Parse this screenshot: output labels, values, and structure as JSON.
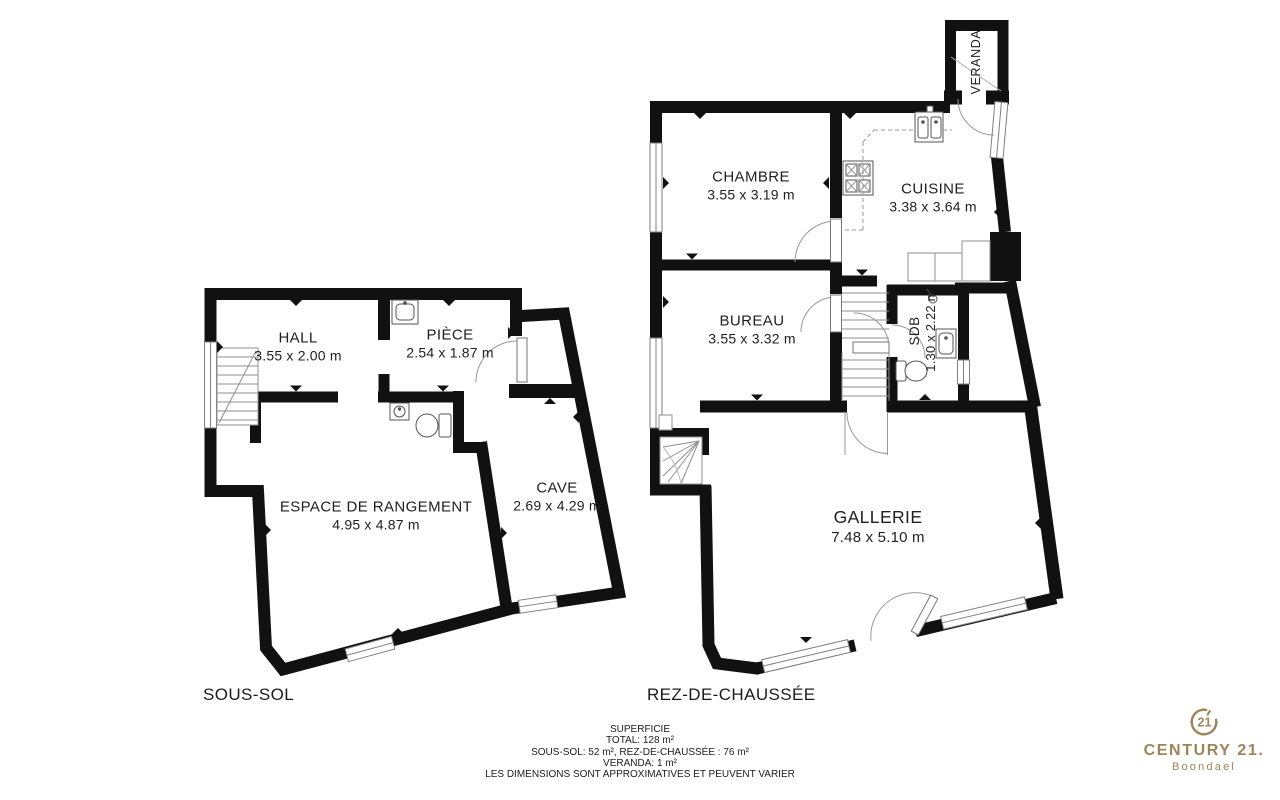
{
  "plans": {
    "sous_sol": {
      "label": "SOUS-SOL",
      "rooms": {
        "hall": {
          "name": "HALL",
          "dims": "3.55 x 2.00 m"
        },
        "piece": {
          "name": "PIÈCE",
          "dims": "2.54 x 1.87 m"
        },
        "espace_de_rangement": {
          "name": "ESPACE DE RANGEMENT",
          "dims": "4.95 x 4.87 m"
        },
        "cave": {
          "name": "CAVE",
          "dims": "2.69 x 4.29 m"
        }
      }
    },
    "rez_de_chaussee": {
      "label": "REZ-DE-CHAUSSÉE",
      "rooms": {
        "veranda": {
          "name": "VERANDA"
        },
        "chambre": {
          "name": "CHAMBRE",
          "dims": "3.55 x 3.19 m"
        },
        "cuisine": {
          "name": "CUISINE",
          "dims": "3.38 x 3.64 m"
        },
        "bureau": {
          "name": "BUREAU",
          "dims": "3.55 x 3.32 m"
        },
        "sdb": {
          "name": "SDB",
          "dims": "1.30 x 2.22 m"
        },
        "gallerie": {
          "name": "GALLERIE",
          "dims": "7.48 x 5.10 m"
        }
      }
    }
  },
  "summary": {
    "title": "SUPERFICIE",
    "total": "TOTAL: 128 m²",
    "floors": "SOUS-SOL: 52 m², REZ-DE-CHAUSSÉE : 76 m²",
    "veranda": "VERANDA: 1 m²",
    "disclaimer": "LES DIMENSIONS SONT APPROXIMATIVES ET PEUVENT VARIER"
  },
  "logo": {
    "seal": "21",
    "brand": "CENTURY 21.",
    "agency": "Boondael",
    "color": "#9B8659"
  },
  "colors": {
    "wall": "#111111",
    "fixture_line": "#8f8f8f",
    "arc_line": "#999999",
    "text": "#1f1f1f",
    "background": "#ffffff"
  }
}
